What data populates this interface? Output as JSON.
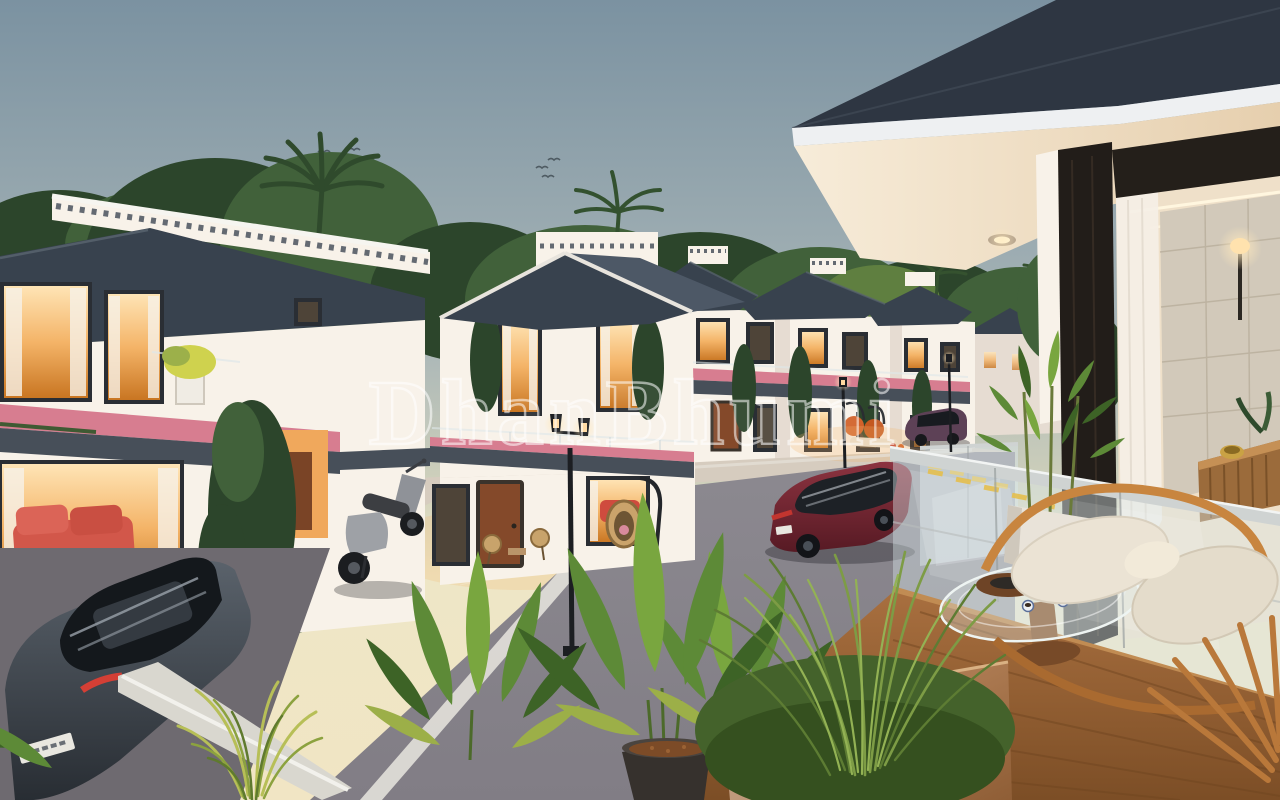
{
  "title": "Villa community dusk render",
  "watermark": {
    "text": "DhanBhumi"
  },
  "colors": {
    "sky_top": "#7b92a1",
    "sky_mid": "#a8b5b7",
    "sky_horizon": "#eee6c6",
    "foliage_dark": "#2c452b",
    "foliage_mid": "#41613a",
    "foliage_light": "#5f7f40",
    "roof": "#38424e",
    "roof_light": "#4d5866",
    "wall": "#f8f2e9",
    "wall_shadow": "#e6dcd2",
    "fascia": "#474f59",
    "window_glow": "#f4b468",
    "window_frame": "#2a2e34",
    "flower_pink": "#d77d90",
    "door_wood": "#84492a",
    "road": "#8c8990",
    "sidewalk": "#d6ccbf",
    "lane_line": "#e9e6df",
    "curb_yellow": "#e5bf4e",
    "suv_red": "#74232f",
    "car_gray": "#4d545c",
    "car_plum": "#5d4156",
    "scooter_gray": "#8f9298",
    "lamp_black": "#1c1e22",
    "deck_wood": "#a86f3f",
    "deck_wood_dark": "#7c4e26",
    "rail_wood": "#c18c53",
    "glass_tint": "#d9e6ea",
    "cushion": "#ebe3d4",
    "planter_white": "#e9e3d9",
    "planter_copper": "#b08055",
    "pot_dark": "#36312d",
    "mulch": "#7c4b27",
    "stone_wall": "#d2c9ba",
    "soffit": "#f5e9d5",
    "interior_glow": "#f3d9a8",
    "leaf_green": "#5d8a37",
    "leaf_dark": "#3d6326",
    "leaf_light": "#79a63f",
    "leaf_yellow": "#9caf48",
    "watermark": "#ffffff"
  },
  "scene": {
    "description": "3D architectural rendering of a gated villa community at dusk, viewed from a private balcony overlooking a tree-lined internal street.",
    "time_of_day": "dusk",
    "objects": [
      "white two-storey villas with slate hip roofs and dentil parapets",
      "pink balcony flower boxes",
      "warm lit windows and patios",
      "black twin-head street lamps",
      "red SUV driving on street",
      "plum hatchback parked across street",
      "gray sedan parked below balcony",
      "scooter parked at villa patio",
      "glass balcony railing with wooden rails",
      "balcony wood deck",
      "curved wooden lounge chair with white cushions",
      "oval glass coffee table with tea set",
      "white bamboo planter",
      "banana-leaf plants in dark pot",
      "ornamental grass in copper planter",
      "palm trees and dense tree line",
      "flock of birds in dusk sky",
      "modern villa roof overhang with recessed soffit lights",
      "interior hallway with stone wall, wall sconce and wooden console"
    ]
  }
}
